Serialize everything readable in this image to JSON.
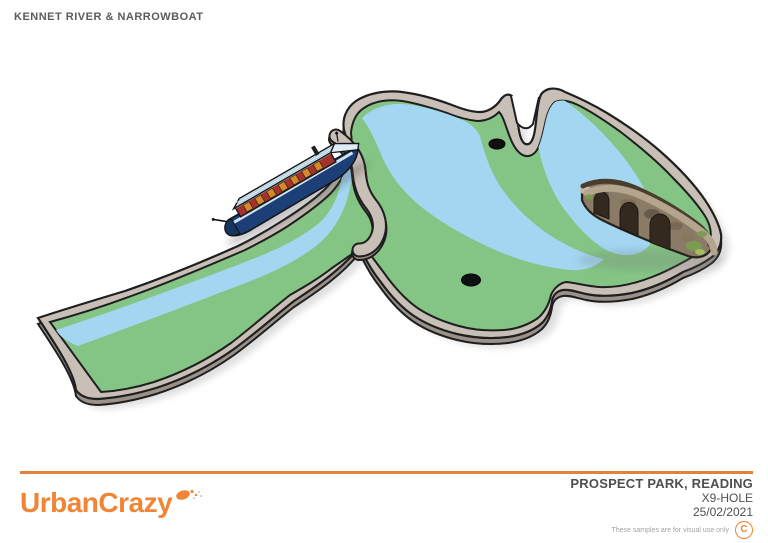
{
  "header": {
    "title": "KENNET RIVER & NARROWBOAT"
  },
  "footer": {
    "brand": "UrbanCrazy",
    "site": "PROSPECT PARK, READING",
    "hole_ref": "X9-HOLE",
    "date": "25/02/2021",
    "disclaimer": "These samples are for visual use only",
    "copyright_symbol": "C"
  },
  "illustration": {
    "subject": "Isometric plan of mini golf hole with river channel, narrowboat and stone bridge",
    "hole_count": "2",
    "features": [
      "winding river channel",
      "grass banks",
      "kerb walls",
      "narrowboat on left bank",
      "three-arch stone bridge over right channel",
      "two hole cups"
    ],
    "colors": {
      "water": "#a3d6f1",
      "grass": "#84c585",
      "curb_top": "#c8bfb7",
      "curb_side": "#9a928a",
      "outline": "#1f1f1f",
      "shadow": "#dedede",
      "hole": "#101010",
      "boat_hull": "#1d3f77",
      "boat_cabin": "#a3322c",
      "boat_window": "#d8882c",
      "boat_roof": "#d9edf5",
      "boat_bow": "#dfeef6",
      "bridge_stone": "#8a7b66",
      "bridge_walkway": "#b3a58e",
      "bridge_arch": "#33291e",
      "bridge_moss": "#7b9b4f",
      "accent": "#ef8535"
    }
  }
}
